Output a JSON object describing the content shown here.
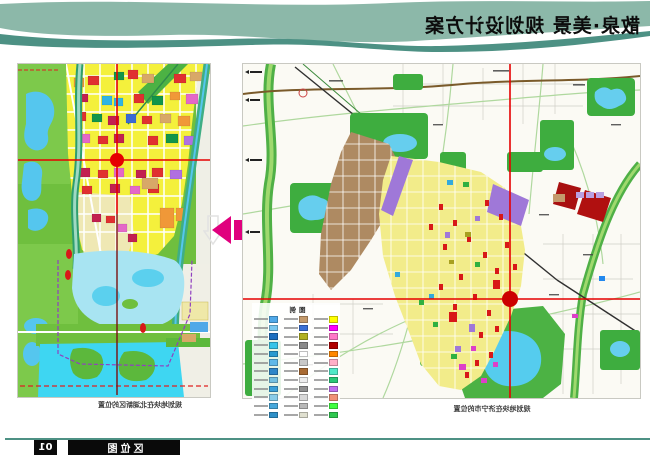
{
  "header": {
    "title": "散泉·美景 规划设计方案"
  },
  "left_map": {
    "caption": "规划地块在北湖新区的位置"
  },
  "right_map": {
    "caption": "规划地块在济宁市的位置",
    "legend": {
      "title": "图例",
      "rows": [
        [
          "#4FA8E8",
          "#C49A6C",
          "#FFFF00"
        ],
        [
          "#79C8F0",
          "#3B6FD4",
          "#FF00FF"
        ],
        [
          "#1E6FC0",
          "#B0B020",
          "#FF78C8"
        ],
        [
          "#35C4E8",
          "#8A8A8A",
          "#B00000"
        ],
        [
          "#2A9AD0",
          "#FFFFFF",
          "#FF8800"
        ],
        [
          "#5FB8E8",
          "#C8C8C8",
          "#FFB0C8"
        ],
        [
          "#2E86C8",
          "#A86A32",
          "#50E8C8"
        ],
        [
          "#74C0E0",
          "#EDEDED",
          "#28C878"
        ],
        [
          "#3AA0D8",
          "#909090",
          "#C070F0"
        ],
        [
          "#88CCE8",
          "#D8D8D8",
          "#F09078"
        ],
        [
          "#47A8DC",
          "#B8B8B8",
          "#40FF40"
        ],
        [
          "#2F90C8",
          "#E0E0D0",
          "#30C850"
        ]
      ]
    }
  },
  "footer": {
    "page_number": "01",
    "section_label": "区位图"
  },
  "colors": {
    "banner_teal": "#8CB8A9",
    "banner_dark_teal": "#4D9184",
    "crosshair_red": "#E60000",
    "arrow_pink": "#E0007E",
    "footer_line": "#4D9184"
  }
}
